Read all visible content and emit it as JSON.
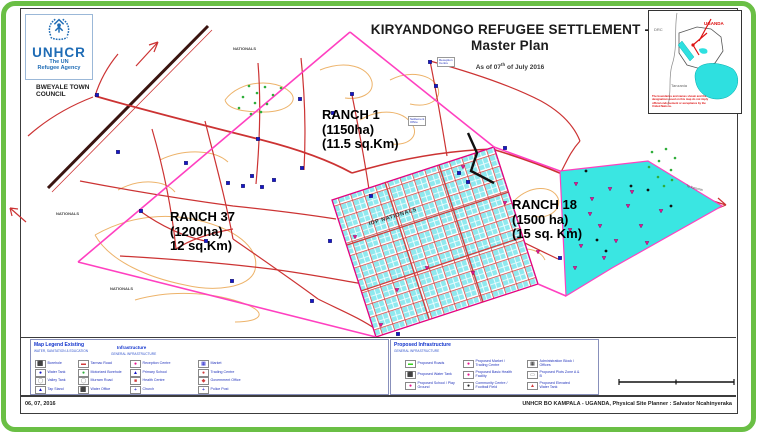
{
  "frame": {
    "border_color": "#6abf45"
  },
  "logo": {
    "acronym": "UNHCR",
    "tagline1": "The UN",
    "tagline2": "Refugee Agency",
    "color": "#1f6cb5"
  },
  "title": {
    "line1": "KIRYANDONGO REFUGEE SETTLEMENT -",
    "line2": "Master Plan",
    "as_of_prefix": "As of 07",
    "as_of_sup": "th",
    "as_of_suffix": " of July 2016"
  },
  "map": {
    "labels": {
      "town_council_line1": "BWEYALE TOWN",
      "town_council_line2": "COUNCIL",
      "ranch1_line1": "RANCH 1",
      "ranch1_line2": "(1150ha)",
      "ranch1_line3": "(11.5 sq.Km)",
      "ranch37_line1": "RANCH 37",
      "ranch37_line2": "(1200ha)",
      "ranch37_line3": "12 sq.Km)",
      "ranch18_line1": "RANCH 18",
      "ranch18_line2": "(1500 ha)",
      "ranch18_line3": "(15 sq. Km)",
      "idp_block": "IDP NATIONALS",
      "nationals": "NATIONALS",
      "road_east": "To Karuma"
    },
    "pois": [
      {
        "line1": "Settlement",
        "line2": "Office"
      },
      {
        "line1": "Reception",
        "line2": "Centre"
      }
    ],
    "colors": {
      "road_red": "#cc3333",
      "boundary_pink": "#ff40c0",
      "contour_tan": "#edb36a",
      "plots_cyan": "#8fe9ef",
      "ranch18_cyan": "#3ae6e2",
      "marker_blue": "#1616c8",
      "marker_green": "#2fae3a",
      "marker_magenta": "#e8128e",
      "railway_dark": "#3a1410"
    }
  },
  "inset": {
    "uganda": "UGANDA",
    "drc": "DRC",
    "tanzania": "Tanzania",
    "disclaimer_line1": "The boundaries and names shown and the",
    "disclaimer_line2": "designations used on this map do not imply",
    "disclaimer_line3": "official endorsement or acceptance by the",
    "disclaimer_line4": "United Nations."
  },
  "legend_existing": {
    "title": "Map Legend Existing",
    "subnote": "WATER, SANITATION & EDUCATION",
    "subtitle": "Infrastructure",
    "subtitle_note": "GENERAL INFRASTRUCTURE",
    "columns": [
      [
        {
          "glyph": "⬛",
          "color": "#1616c8",
          "label": "Borehole"
        },
        {
          "glyph": "●",
          "color": "#1616c8",
          "label": "Water Tank"
        },
        {
          "glyph": "◯",
          "color": "#777777",
          "label": "Valley Tank"
        },
        {
          "glyph": "▲",
          "color": "#1616c8",
          "label": "Tap Stand"
        }
      ],
      [
        {
          "glyph": "▬",
          "color": "#d23b3b",
          "label": "Tarmac Road"
        },
        {
          "glyph": "●",
          "color": "#2fae3a",
          "label": "Motorized Borehole"
        },
        {
          "glyph": "◯",
          "color": "#777777",
          "label": "Murram Road"
        },
        {
          "glyph": "⬛",
          "color": "#1616c8",
          "label": "Water Office"
        }
      ],
      [
        {
          "glyph": "●",
          "color": "#e8128e",
          "label": "Reception Centre"
        },
        {
          "glyph": "▲",
          "color": "#1616c8",
          "label": "Primary School"
        },
        {
          "glyph": "■",
          "color": "#d23b3b",
          "label": "Health Centre"
        },
        {
          "glyph": "+",
          "color": "#1616c8",
          "label": "Church"
        }
      ],
      [
        {
          "glyph": "▦",
          "color": "#1616c8",
          "label": "Market"
        },
        {
          "glyph": "●",
          "color": "#d23b3b",
          "label": "Trading Centre"
        },
        {
          "glyph": "◆",
          "color": "#d23b3b",
          "label": "Government Office"
        },
        {
          "glyph": "+",
          "color": "#1616c8",
          "label": "Police Post"
        }
      ]
    ]
  },
  "legend_proposed": {
    "title": "Proposed Infrastructure",
    "subnote": "GENERAL INFRASTRUCTURE",
    "columns": [
      [
        {
          "glyph": "▬",
          "color": "#35d21c",
          "label": "Proposed Roads"
        },
        {
          "glyph": "⬛",
          "color": "#222222",
          "label": "Proposed Water Tank"
        },
        {
          "glyph": "●",
          "color": "#e8128e",
          "label": "Proposed School / Play Ground"
        }
      ],
      [
        {
          "glyph": "●",
          "color": "#e8128e",
          "label": "Proposed Market / Trading Centre"
        },
        {
          "glyph": "●",
          "color": "#e8128e",
          "label": "Proposed Basic Health Facility"
        },
        {
          "glyph": "●",
          "color": "#222222",
          "label": "Community Centre / Football Field"
        }
      ],
      [
        {
          "glyph": "▦",
          "color": "#222222",
          "label": "Administration Block / Offices"
        },
        {
          "glyph": "▭",
          "color": "#777777",
          "label": "Proposed Plots Zone A & B"
        },
        {
          "glyph": "▲",
          "color": "#d23b3b",
          "label": "Proposed Elevated Water Tank"
        }
      ]
    ]
  },
  "footer": {
    "date": "06, 07, 2016",
    "credit": "UNHCR BO KAMPALA - UGANDA, Physical Site Planner : Salvator Ncahinyeraka"
  }
}
